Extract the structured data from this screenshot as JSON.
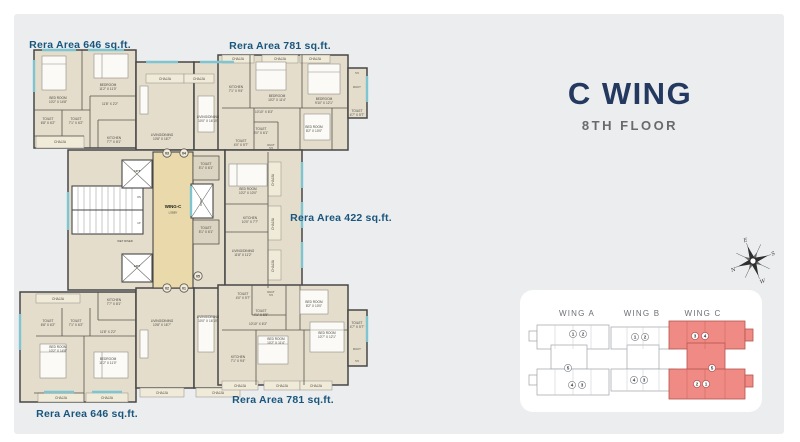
{
  "header": {
    "title": "C WING",
    "subtitle": "8TH FLOOR",
    "title_color": "#24395f",
    "subtitle_color": "#6a6a6e"
  },
  "colors": {
    "panel_bg": "#ebedee",
    "wall": "#474747",
    "room_fill": "#e4ddcc",
    "chajja_fill": "#f0ead9",
    "lobby_fill": "#e9d9ab",
    "window": "#7fc5d1",
    "room_label": "#4a4840",
    "area_label": "#19567e",
    "keyplan_highlight": "#ef8b84",
    "keyplan_highlight_stroke": "#b5534e",
    "keyplan_outline": "#a7adb3"
  },
  "floorplan": {
    "area_labels": [
      {
        "t": "Rera Area 646 sq.ft.",
        "x": 80,
        "y": 48
      },
      {
        "t": "Rera Area 781 sq.ft.",
        "x": 280,
        "y": 49
      },
      {
        "t": "Rera Area 422 sq.ft.",
        "x": 341,
        "y": 221
      },
      {
        "t": "Rera Area 781 sq.ft.",
        "x": 283,
        "y": 403
      },
      {
        "t": "Rera Area 646 sq.ft.",
        "x": 87,
        "y": 417
      }
    ],
    "room_labels": [
      {
        "t": "BED ROOM\n10'2\" X 14'8\"",
        "x": 58,
        "y": 99
      },
      {
        "t": "BEDROOM\n11'2\" X 11'0\"",
        "x": 108,
        "y": 86
      },
      {
        "t": "11'8\" X 2'2\"",
        "x": 110,
        "y": 105
      },
      {
        "t": "TOILET\n6'8\" X 6'2\"",
        "x": 48,
        "y": 120
      },
      {
        "t": "TOILET\n7'1\" X 6'2\"",
        "x": 76,
        "y": 120
      },
      {
        "t": "KITCHEN\n7'7\" X 8'1\"",
        "x": 114,
        "y": 139
      },
      {
        "t": "CHAJJA",
        "x": 60,
        "y": 143
      },
      {
        "t": "LIVING/DINING\n10'8\" X 16'7\"",
        "x": 162,
        "y": 136
      },
      {
        "t": "CHAJJA",
        "x": 165,
        "y": 80
      },
      {
        "t": "CHAJJA",
        "x": 199,
        "y": 80
      },
      {
        "t": "LIVING/DINING\n10'0\" X 16'10\"",
        "x": 208,
        "y": 118
      },
      {
        "t": "CHAJJA",
        "x": 238,
        "y": 60
      },
      {
        "t": "CHAJJA",
        "x": 280,
        "y": 60
      },
      {
        "t": "CHAJJA",
        "x": 315,
        "y": 60
      },
      {
        "t": "KITCHEN\n7'1\" X 9'4\"",
        "x": 236,
        "y": 88
      },
      {
        "t": "BEDROOM\n10'2\" X 11'4\"",
        "x": 277,
        "y": 97
      },
      {
        "t": "BEDROOM\n9'10\" X 12'1\"",
        "x": 324,
        "y": 100
      },
      {
        "t": "10'10\" X 6'3\"",
        "x": 264,
        "y": 113
      },
      {
        "t": "TOILET\n5'0\" X 6'1\"",
        "x": 261,
        "y": 130
      },
      {
        "t": "TOILET\n4'0\" X 5'7\"",
        "x": 241,
        "y": 142
      },
      {
        "t": "DUCT\n5.5",
        "x": 271,
        "y": 146,
        "size": 2.6
      },
      {
        "t": "BED ROOM\n8'2\" X 10'0\"",
        "x": 314,
        "y": 128
      },
      {
        "t": "5.5",
        "x": 357,
        "y": 74,
        "size": 2.6
      },
      {
        "t": "DUCT",
        "x": 357,
        "y": 88,
        "size": 2.8
      },
      {
        "t": "TOILET\n4'7\" X 5'7\"",
        "x": 357,
        "y": 112
      },
      {
        "t": "LIFT",
        "x": 137,
        "y": 172,
        "bold": true,
        "size": 3
      },
      {
        "t": "LIFT",
        "x": 137,
        "y": 267,
        "bold": true,
        "size": 3
      },
      {
        "t": "WING-C",
        "x": 173,
        "y": 208,
        "bold": true,
        "size": 4.4,
        "color": "#1d1c18"
      },
      {
        "t": "LOBBY",
        "x": 173,
        "y": 213.5,
        "size": 2.6
      },
      {
        "t": "WET RISER",
        "x": 125,
        "y": 242,
        "size": 2.8
      },
      {
        "t": "DN",
        "x": 139,
        "y": 198,
        "size": 2.5
      },
      {
        "t": "UP",
        "x": 139,
        "y": 224,
        "size": 2.5
      },
      {
        "t": "DUCT",
        "x": 202,
        "y": 202,
        "size": 2.8,
        "rot": -90
      },
      {
        "t": "TOILET\n5'1\" X 6'1\"",
        "x": 206,
        "y": 165
      },
      {
        "t": "TOILET\n5'1\" X 6'1\"",
        "x": 206,
        "y": 229
      },
      {
        "t": "BED ROOM\n10'2\" X 10'0\"",
        "x": 248,
        "y": 190
      },
      {
        "t": "CHAJJA",
        "x": 274,
        "y": 180,
        "rot": -90
      },
      {
        "t": "KITCHEN\n10'0\" X 7'7\"",
        "x": 250,
        "y": 219
      },
      {
        "t": "CHAJJA",
        "x": 274,
        "y": 224,
        "rot": -90
      },
      {
        "t": "LIVING/DINING\n11'8\" X 11'2\"",
        "x": 243,
        "y": 252
      },
      {
        "t": "CHAJJA",
        "x": 274,
        "y": 266,
        "rot": -90
      },
      {
        "t": "CHAJJA",
        "x": 58,
        "y": 300
      },
      {
        "t": "KITCHEN\n7'7\" X 8'1\"",
        "x": 114,
        "y": 301
      },
      {
        "t": "TOILET\n6'8\" X 6'2\"",
        "x": 48,
        "y": 322
      },
      {
        "t": "TOILET\n7'1\" X 6'2\"",
        "x": 76,
        "y": 322
      },
      {
        "t": "11'8\" X 2'2\"",
        "x": 108,
        "y": 333
      },
      {
        "t": "LIVING/DINING\n10'8\" X 16'7\"",
        "x": 162,
        "y": 322
      },
      {
        "t": "LIVING/DINING\n10'0\" X 16'10\"",
        "x": 208,
        "y": 318
      },
      {
        "t": "BED ROOM\n10'2\" X 14'8\"",
        "x": 58,
        "y": 348
      },
      {
        "t": "BEDROOM\n11'2\" X 11'0\"",
        "x": 108,
        "y": 360
      },
      {
        "t": "CHAJJA",
        "x": 61,
        "y": 399
      },
      {
        "t": "CHAJJA",
        "x": 107,
        "y": 399
      },
      {
        "t": "CHAJJA",
        "x": 162,
        "y": 394
      },
      {
        "t": "CHAJJA",
        "x": 218,
        "y": 394
      },
      {
        "t": "TOILET\n4'0\" X 5'7\"",
        "x": 243,
        "y": 295
      },
      {
        "t": "DUCT\n5.5",
        "x": 271,
        "y": 293,
        "size": 2.6
      },
      {
        "t": "TOILET\n4'1\" X 5'5\"",
        "x": 261,
        "y": 312
      },
      {
        "t": "BED ROOM\n8'2\" X 10'0\"",
        "x": 314,
        "y": 303
      },
      {
        "t": "10'10\" X 6'3\"",
        "x": 258,
        "y": 325
      },
      {
        "t": "BED ROOM\n10'2\" X 11'4\"",
        "x": 276,
        "y": 340
      },
      {
        "t": "BED ROOM\n10'7\" X 12'1\"",
        "x": 327,
        "y": 334
      },
      {
        "t": "KITCHEN\n7'1\" X 9'4\"",
        "x": 238,
        "y": 358
      },
      {
        "t": "TOILET\n4'7\" X 5'7\"",
        "x": 357,
        "y": 324
      },
      {
        "t": "DUCT",
        "x": 357,
        "y": 350,
        "size": 2.8
      },
      {
        "t": "5.5",
        "x": 357,
        "y": 362,
        "size": 2.6
      },
      {
        "t": "CHAJJA",
        "x": 240,
        "y": 387
      },
      {
        "t": "CHAJJA",
        "x": 282,
        "y": 387
      },
      {
        "t": "CHAJJA",
        "x": 316,
        "y": 387
      }
    ],
    "door_numbers": [
      {
        "t": "03",
        "x": 167,
        "y": 153
      },
      {
        "t": "04",
        "x": 184,
        "y": 153
      },
      {
        "t": "02",
        "x": 167,
        "y": 288
      },
      {
        "t": "01",
        "x": 184,
        "y": 288
      },
      {
        "t": "05",
        "x": 198,
        "y": 276
      }
    ]
  },
  "keyplan": {
    "wings": [
      {
        "label": "WING A",
        "highlighted": false,
        "label_x": 72,
        "units": [
          {
            "n": "1",
            "x": 68,
            "y": 49
          },
          {
            "n": "2",
            "x": 78,
            "y": 49
          },
          {
            "n": "5",
            "x": 63,
            "y": 83
          },
          {
            "n": "4",
            "x": 67,
            "y": 100
          },
          {
            "n": "3",
            "x": 77,
            "y": 100
          }
        ]
      },
      {
        "label": "WING B",
        "highlighted": false,
        "label_x": 137,
        "units": [
          {
            "n": "1",
            "x": 130,
            "y": 52
          },
          {
            "n": "2",
            "x": 140,
            "y": 52
          },
          {
            "n": "4",
            "x": 129,
            "y": 95
          },
          {
            "n": "3",
            "x": 139,
            "y": 95
          }
        ]
      },
      {
        "label": "WING C",
        "highlighted": true,
        "label_x": 198,
        "units": [
          {
            "n": "3",
            "x": 190,
            "y": 51
          },
          {
            "n": "4",
            "x": 200,
            "y": 51
          },
          {
            "n": "5",
            "x": 207,
            "y": 83
          },
          {
            "n": "2",
            "x": 192,
            "y": 99
          },
          {
            "n": "1",
            "x": 201,
            "y": 99
          }
        ]
      }
    ]
  },
  "compass": {
    "letters": [
      {
        "t": "E",
        "x": 0,
        "y": -20.5
      },
      {
        "t": "S",
        "x": 21.5,
        "y": 1.5
      },
      {
        "t": "W",
        "x": 2,
        "y": 24
      },
      {
        "t": "N",
        "x": -21.5,
        "y": 3
      }
    ]
  }
}
